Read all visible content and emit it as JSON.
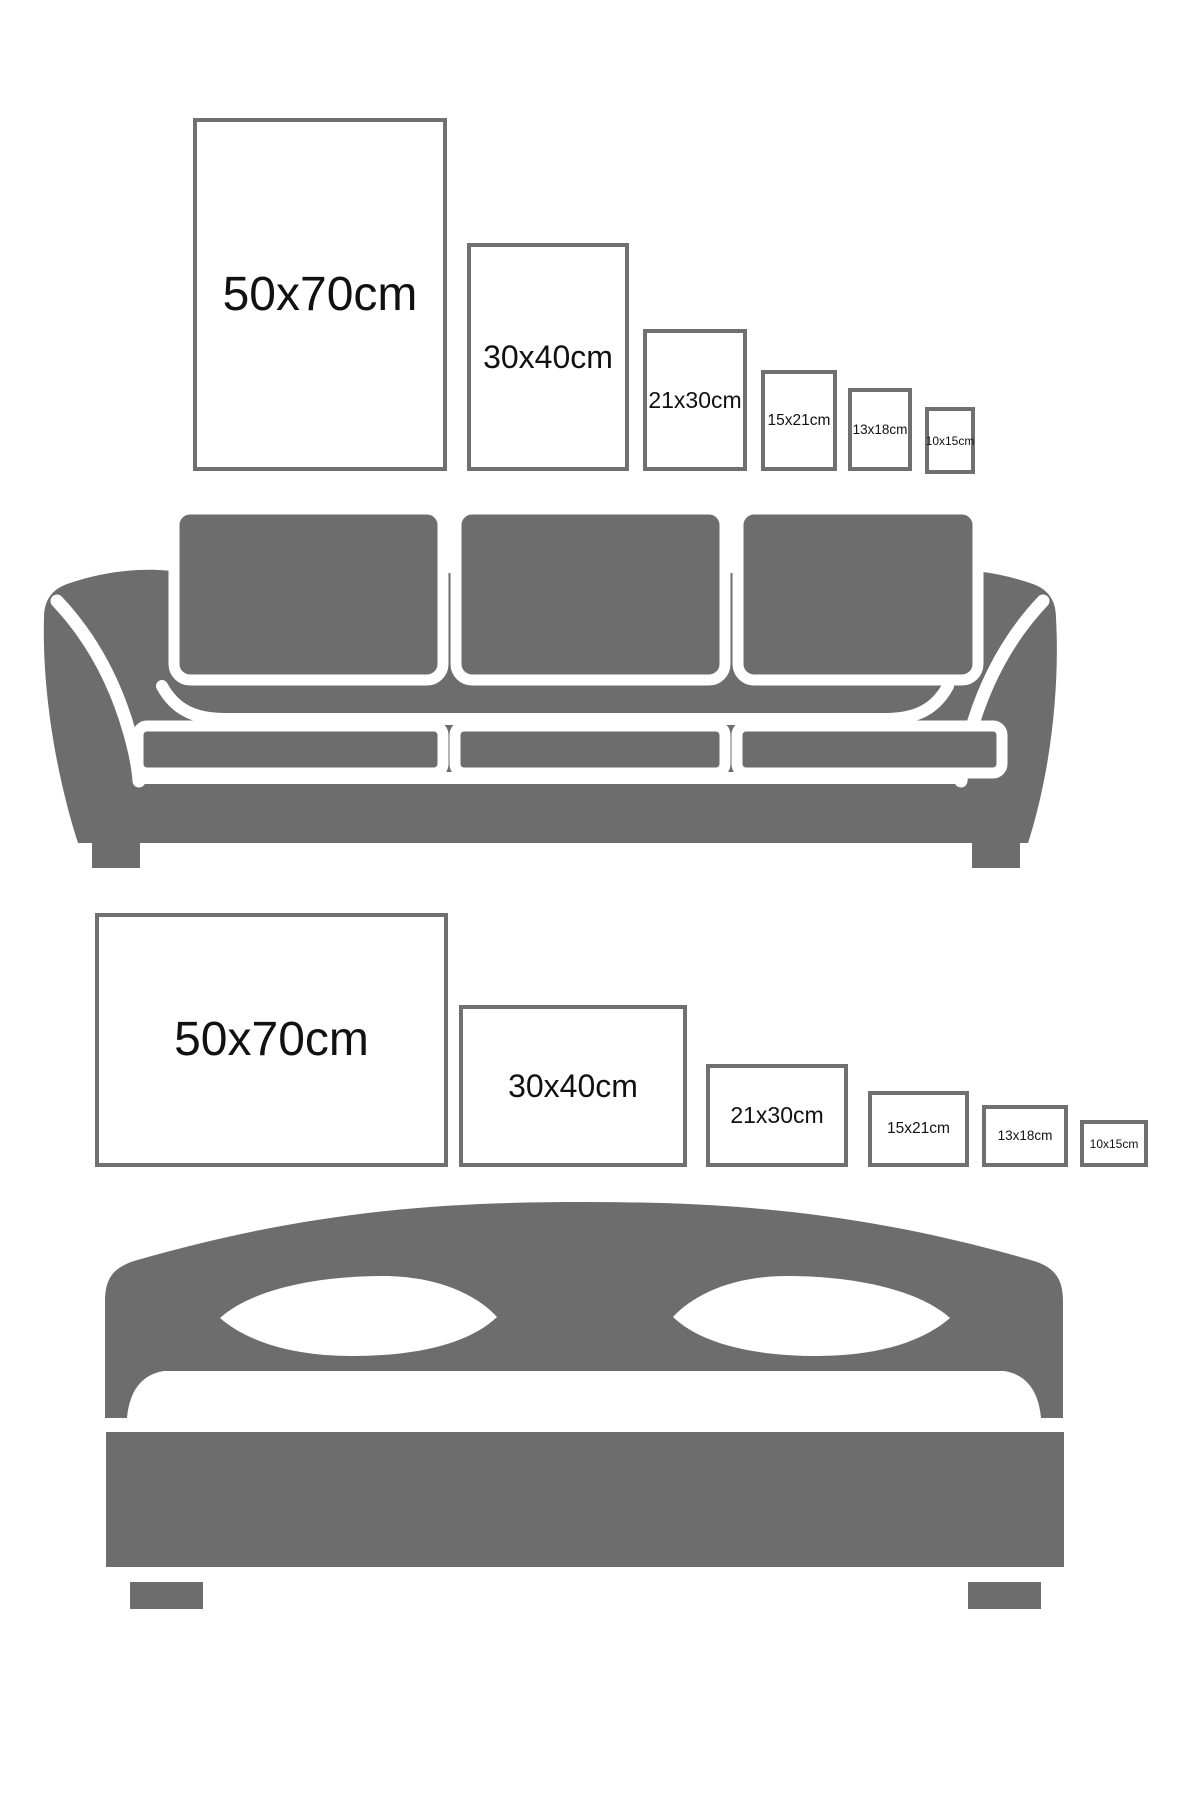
{
  "colors": {
    "furniture": "#6d6d6d",
    "frame_border": "#707070",
    "frame_fill": "#ffffff",
    "label_text": "#111111",
    "separator_white": "#ffffff",
    "pillow_white": "#ffffff",
    "background": "#ffffff"
  },
  "sofa_section": {
    "illustration": "sofa",
    "frames": [
      {
        "label": "50x70cm",
        "orientation": "portrait"
      },
      {
        "label": "30x40cm",
        "orientation": "portrait"
      },
      {
        "label": "21x30cm",
        "orientation": "portrait"
      },
      {
        "label": "15x21cm",
        "orientation": "portrait"
      },
      {
        "label": "13x18cm",
        "orientation": "portrait"
      },
      {
        "label": "10x15cm",
        "orientation": "portrait"
      }
    ]
  },
  "bed_section": {
    "illustration": "bed",
    "frames": [
      {
        "label": "50x70cm",
        "orientation": "landscape"
      },
      {
        "label": "30x40cm",
        "orientation": "landscape"
      },
      {
        "label": "21x30cm",
        "orientation": "landscape"
      },
      {
        "label": "15x21cm",
        "orientation": "landscape"
      },
      {
        "label": "13x18cm",
        "orientation": "landscape"
      },
      {
        "label": "10x15cm",
        "orientation": "landscape"
      }
    ]
  }
}
